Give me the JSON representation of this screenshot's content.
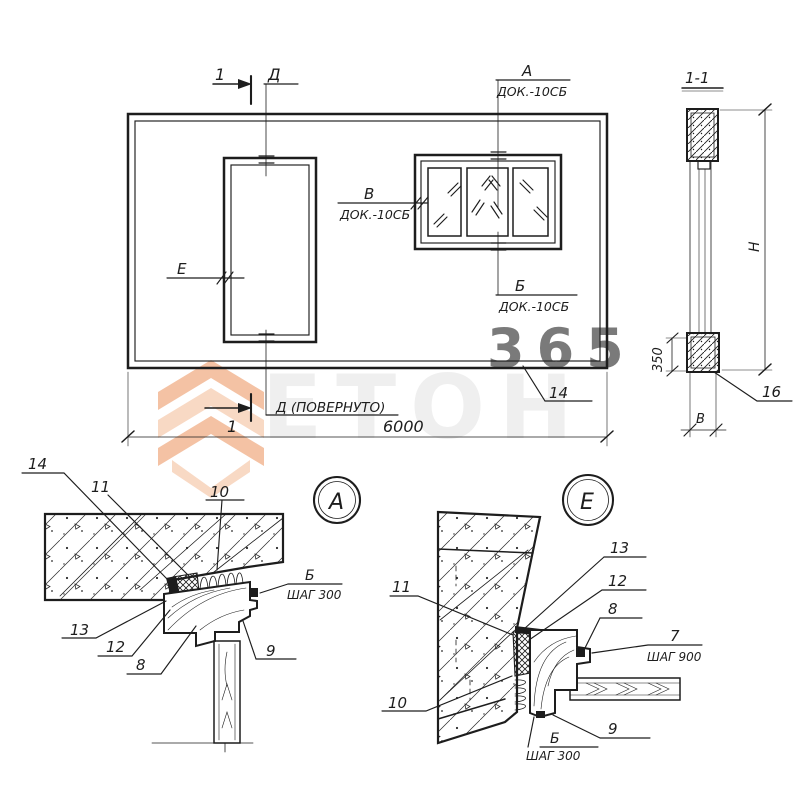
{
  "drawing": {
    "main_view": {
      "section_cut_top": "1",
      "section_cut_bottom": "1",
      "axis_top": "Д",
      "axis_rotated": "Д (ПОВЕРНУТО)",
      "node_a": "А",
      "node_a_ref": "ДОК.-10СБ",
      "node_v": "В",
      "node_v_ref": "ДОК.-10СБ",
      "node_b": "Б",
      "node_b_ref": "ДОК.-10СБ",
      "node_e": "Е",
      "width_dim": "6000",
      "callout_panel": "14"
    },
    "section_1_1": {
      "title": "1-1",
      "height_dim": "Н",
      "rail_dim": "350",
      "thickness_dim": "В",
      "callout": "16"
    },
    "detail_a": {
      "title": "А",
      "callouts": {
        "c14": "14",
        "c11": "11",
        "c10": "10",
        "c13": "13",
        "c12": "12",
        "c8": "8",
        "c9": "9"
      },
      "fastener": "Б",
      "fastener_step": "ШАГ 300"
    },
    "detail_e": {
      "title": "Е",
      "callouts": {
        "c11": "11",
        "c10": "10",
        "c13": "13",
        "c12": "12",
        "c8": "8",
        "c9": "9"
      },
      "screw": "7",
      "screw_step": "ШАГ 900",
      "fastener": "Б",
      "fastener_step": "ШАГ 300"
    }
  },
  "watermark": {
    "brand_number": "365",
    "brand_name": "ЕТОН",
    "accent_color": "#ed9263",
    "gray_color": "#000000"
  }
}
